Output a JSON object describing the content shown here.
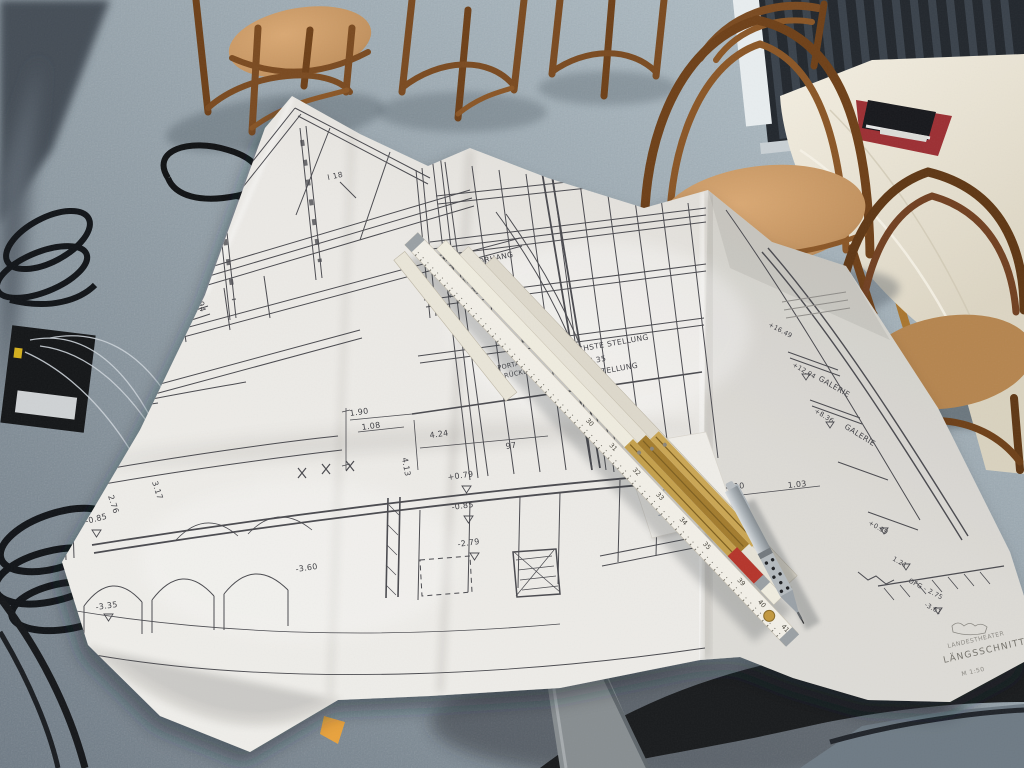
{
  "blueprint": {
    "labels": {
      "beam": "I 18",
      "safety_curtain_1": "STAHL-",
      "safety_curtain_2": "SCHUTZVORHANG",
      "sound_curtain_1": "SCHALL-",
      "sound_curtain_2": "VORHANG",
      "highest_position": "HÖCHSTE STELLUNG",
      "highest_value": "+7.35",
      "lowest_position": "TIEFSTE STELLUNG",
      "lowest_value": "+1.00",
      "portal_1": "PORTAL-",
      "portal_2": "BRÜCKE",
      "gallery_1": "GALERIE",
      "gallery_2": "GALERIE",
      "elev_16": "+16.49",
      "elev_12": "+12.04",
      "elev_8": "+8.36"
    },
    "dims": {
      "d478": "4.78",
      "d194": "1.94",
      "d276": "2.76",
      "d317": "3.17",
      "m085l": "-0.85",
      "m335": "-3.35",
      "d190": "1.90",
      "d108": "1.08",
      "d413": "4.13",
      "d424": "4.24",
      "d97": "97",
      "p079": "+0.79",
      "m085c": "-0.85",
      "m279": "-2.79",
      "m360": "-3.60",
      "d410": "4.10",
      "d103": "1.03",
      "p039": "+0.39",
      "d121": "1.21",
      "ofg": "OFG - 2.75",
      "m361": "-3.61"
    },
    "titleblock": {
      "project": "LANDESTHEATER",
      "sheet": "LÄNGSSCHNITT",
      "scale": "M 1:50"
    }
  },
  "note": {
    "line1": "22 cm",
    "line2": "12,4 - 4,8",
    "line3": "12"
  },
  "ruler": {
    "numbers": [
      "30",
      "31",
      "32",
      "33",
      "34",
      "35",
      "39",
      "40",
      "41"
    ]
  },
  "colors": {
    "carpet": "#8d9aa3",
    "paper": "#e9e6e1",
    "wood": "#8a5a2b",
    "seat": "#c2925f",
    "brass": "#b5913f",
    "ruler_red": "#b5352b",
    "doily_red": "#9c2f33",
    "ink": "#46464b"
  }
}
